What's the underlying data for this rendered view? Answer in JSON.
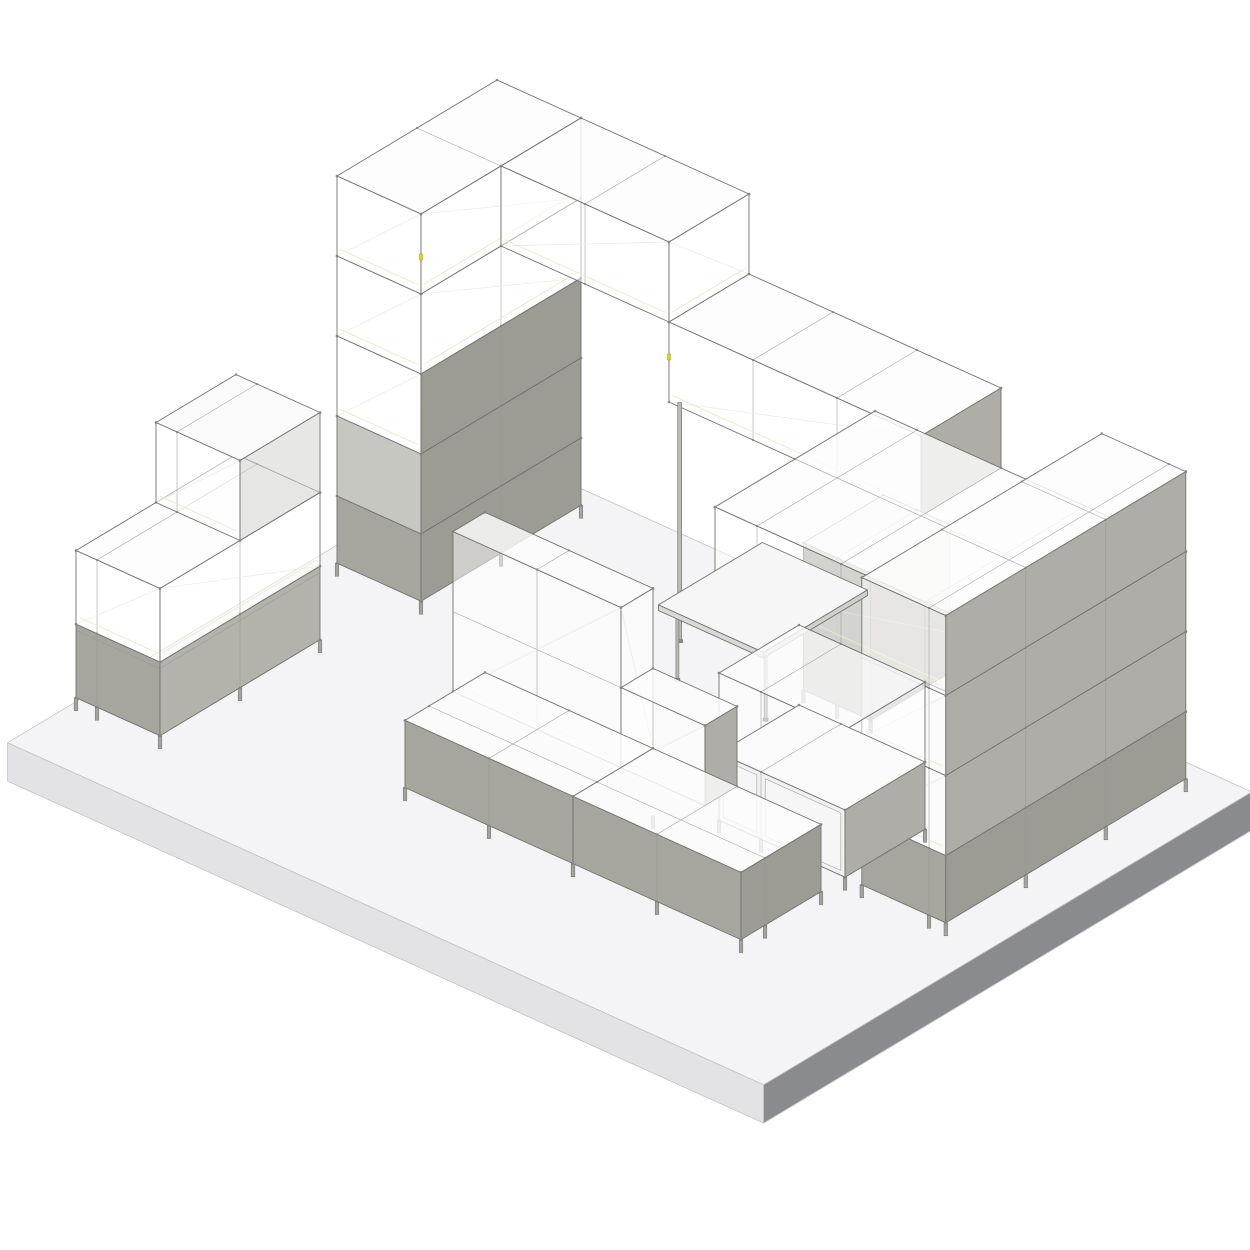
{
  "meta": {
    "description": "Isometric 3D rendering of a modular shelving furniture layout on a raised floor plate"
  },
  "palette": {
    "glass": "rgba(255,255,255,0.50)",
    "glassTop": "rgba(252,252,253,0.82)",
    "innerGlass": "rgba(208,208,203,0.50)",
    "white": "#fafafb",
    "grayFront": "#a7a69e",
    "grayFrontLight": "#b4b3ab",
    "grayInner": "#c7c7c2",
    "graySide": "#9c9b94",
    "graySideLight": "#aeada7",
    "door": "#f1f1f2",
    "frame": "#72726e",
    "grid": "#96968f",
    "dot": "#84847f",
    "leg": "#a3a3a0",
    "legStroke": "#6e6e6a",
    "post": "#b9b9b6",
    "postFoot": "#8f8f8c",
    "sticker": "#e6d700",
    "deskTop": "#f6f6f7",
    "deskEdgeS": "#d9d9d7",
    "deskEdgeE": "#cfcfcc",
    "warmLine": "#eceac9",
    "diagLine": "rgba(230,230,225,0.75)"
  },
  "projection": {
    "ox": 497,
    "oy": 480,
    "ex": 84,
    "ey": 38,
    "sx": -80,
    "sy": 48,
    "v": 80,
    "leg_height": 13
  },
  "floor": {
    "name": "floor-plate",
    "x": [
      -0.35,
      8.65
    ],
    "y": [
      -0.35,
      5.75
    ],
    "thickness": 0.48,
    "top": "#f4f4f6",
    "edge_sw": "#e3e3e5",
    "edge_se": "#898b8e",
    "stroke": "#c2c2c5"
  },
  "items": [
    {
      "kind": "box",
      "name": "tower-level-3",
      "x": [
        0,
        1
      ],
      "y": [
        0,
        2
      ],
      "z": [
        3,
        4
      ],
      "faces": {
        "s": "glass",
        "e": "glass"
      }
    },
    {
      "kind": "box",
      "name": "tower-level-2",
      "x": [
        0,
        1
      ],
      "y": [
        0,
        2
      ],
      "z": [
        2,
        3
      ],
      "faces": {
        "s": "glass",
        "e": "graySide"
      }
    },
    {
      "kind": "box",
      "name": "tower-level-1",
      "x": [
        0,
        1
      ],
      "y": [
        0,
        2
      ],
      "z": [
        1,
        2
      ],
      "faces": {
        "s": "grayInner",
        "e": "graySide"
      }
    },
    {
      "kind": "box",
      "name": "tower-level-0",
      "x": [
        0,
        1
      ],
      "y": [
        0,
        2
      ],
      "z": [
        0.16,
        1
      ],
      "faces": {
        "s": "grayFront",
        "e": "graySide"
      },
      "legs": true
    },
    {
      "kind": "box",
      "name": "bridge-over-tower",
      "x": [
        0,
        1
      ],
      "y": [
        0,
        2
      ],
      "z": [
        4,
        5
      ],
      "faces": {
        "top": "glassTop",
        "s": "glass",
        "e": "glass"
      }
    },
    {
      "kind": "box",
      "name": "bridge-span",
      "x": [
        1,
        3
      ],
      "y": [
        0,
        1
      ],
      "z": [
        4,
        5
      ],
      "faces": {
        "top": "glassTop",
        "s": "glass",
        "e": "glass"
      }
    },
    {
      "kind": "sticker",
      "name": "connector-label",
      "x": 1,
      "y": 2,
      "z": 4.5
    },
    {
      "kind": "box",
      "name": "upper-run",
      "x": [
        3,
        6
      ],
      "y": [
        0,
        1
      ],
      "z": [
        3,
        4
      ],
      "faces": {
        "top": "glassTop",
        "s": "glass",
        "e": "graySideLight"
      }
    },
    {
      "kind": "sticker",
      "name": "connector-label",
      "x": 3,
      "y": 1,
      "z": 3.6
    },
    {
      "kind": "post",
      "name": "support-post",
      "x": 3.08,
      "y": 0.95,
      "z": [
        0,
        3
      ],
      "w": 4
    },
    {
      "kind": "box",
      "name": "mid-support-column",
      "x": [
        4.6,
        5.4
      ],
      "y": [
        0,
        1
      ],
      "z": [
        0.16,
        2
      ],
      "faces": {
        "top": "white",
        "s": "grayFront",
        "e": "graySide"
      },
      "legs": true
    },
    {
      "kind": "box",
      "name": "lower-run",
      "x": [
        4.5,
        8.2
      ],
      "y": [
        0,
        2
      ],
      "z": [
        2,
        3
      ],
      "faces": {
        "top": "glassTop",
        "s": "glass",
        "e": "graySideLight"
      }
    },
    {
      "kind": "box",
      "name": "right-tower-level-3",
      "x": [
        7.2,
        8.2
      ],
      "y": [
        0,
        3
      ],
      "z": [
        3,
        4
      ],
      "faces": {
        "top": "glassTop",
        "s": "glass",
        "e": "graySideLight"
      }
    },
    {
      "kind": "box",
      "name": "right-tower-level-2",
      "x": [
        7.2,
        8.2
      ],
      "y": [
        0,
        3
      ],
      "z": [
        2,
        3
      ],
      "faces": {
        "s": "glass",
        "e": "graySideLight"
      }
    },
    {
      "kind": "box",
      "name": "right-tower-level-1",
      "x": [
        7.2,
        8.2
      ],
      "y": [
        0,
        3
      ],
      "z": [
        1,
        2
      ],
      "faces": {
        "s": "glass",
        "e": "graySideLight"
      }
    },
    {
      "kind": "box",
      "name": "right-tower-level-0",
      "x": [
        7.2,
        8.2
      ],
      "y": [
        0,
        3
      ],
      "z": [
        0.16,
        1
      ],
      "faces": {
        "s": "grayFront",
        "e": "graySide"
      },
      "legs": true
    },
    {
      "kind": "post",
      "name": "desk-leg",
      "x": 3.5,
      "y": 1.42,
      "z": [
        0,
        0.86
      ],
      "w": 3
    },
    {
      "kind": "post",
      "name": "desk-leg",
      "x": 4.55,
      "y": 1.42,
      "z": [
        0,
        0.86
      ],
      "w": 3
    },
    {
      "kind": "box",
      "name": "desk-surface",
      "x": [
        3.35,
        4.6
      ],
      "y": [
        0.2,
        1.5
      ],
      "z": [
        0.86,
        0.93
      ],
      "faces": {
        "top": "deskTop",
        "s": "deskEdgeS",
        "e": "deskEdgeE"
      },
      "plain": true
    },
    {
      "kind": "box",
      "name": "glass-unit-over-cabinet",
      "x": [
        5.5,
        7
      ],
      "y": [
        2,
        3
      ],
      "z": [
        1,
        2
      ],
      "faces": {
        "top": "glassTop",
        "s": "glass",
        "e": "glass"
      }
    },
    {
      "kind": "box",
      "name": "sliding-door-cabinet",
      "x": [
        5.5,
        7
      ],
      "y": [
        2,
        3
      ],
      "z": [
        0.16,
        1
      ],
      "faces": {
        "top": "white",
        "s": "door",
        "e": "graySideLight"
      },
      "legs": true
    },
    {
      "kind": "box",
      "name": "island-back-wall-tall",
      "x": [
        3,
        5
      ],
      "y": [
        3.3,
        3.7
      ],
      "z": [
        1,
        3
      ],
      "faces": {
        "top": "glassTop",
        "s": "glass",
        "e": "glass"
      }
    },
    {
      "kind": "box",
      "name": "island-back-wall-low",
      "x": [
        5,
        6
      ],
      "y": [
        3.3,
        3.7
      ],
      "z": [
        1,
        2
      ],
      "faces": {
        "top": "glassTop",
        "s": "glass",
        "e": "graySideLight"
      }
    },
    {
      "kind": "box",
      "name": "island-bench-west",
      "x": [
        3,
        5
      ],
      "y": [
        3.3,
        4.3
      ],
      "z": [
        0.16,
        1
      ],
      "faces": {
        "top": "glassTop",
        "s": "grayFront"
      },
      "legs": true
    },
    {
      "kind": "box",
      "name": "island-bench-east",
      "x": [
        5,
        7
      ],
      "y": [
        3.3,
        4.3
      ],
      "z": [
        0.16,
        1
      ],
      "faces": {
        "top": "glassTop",
        "s": "grayFront",
        "e": "graySide"
      },
      "legs": true
    },
    {
      "kind": "box",
      "name": "sideboard-lower",
      "x": [
        -0.25,
        0.75
      ],
      "y": [
        3,
        5
      ],
      "z": [
        0.16,
        1.08
      ],
      "faces": {
        "s": "grayFront",
        "e": "grayFrontLight"
      },
      "legs": true
    },
    {
      "kind": "box",
      "name": "sideboard-upper",
      "x": [
        -0.25,
        0.75
      ],
      "y": [
        3,
        5
      ],
      "z": [
        1.08,
        2
      ],
      "faces": {
        "top": "glassTop",
        "s": "glass",
        "e": "glass"
      }
    },
    {
      "kind": "box",
      "name": "sideboard-top-cube",
      "x": [
        -0.25,
        0.75
      ],
      "y": [
        3,
        4
      ],
      "z": [
        2,
        3
      ],
      "faces": {
        "top": "white",
        "s": "glass",
        "e": "innerGlass"
      }
    }
  ]
}
